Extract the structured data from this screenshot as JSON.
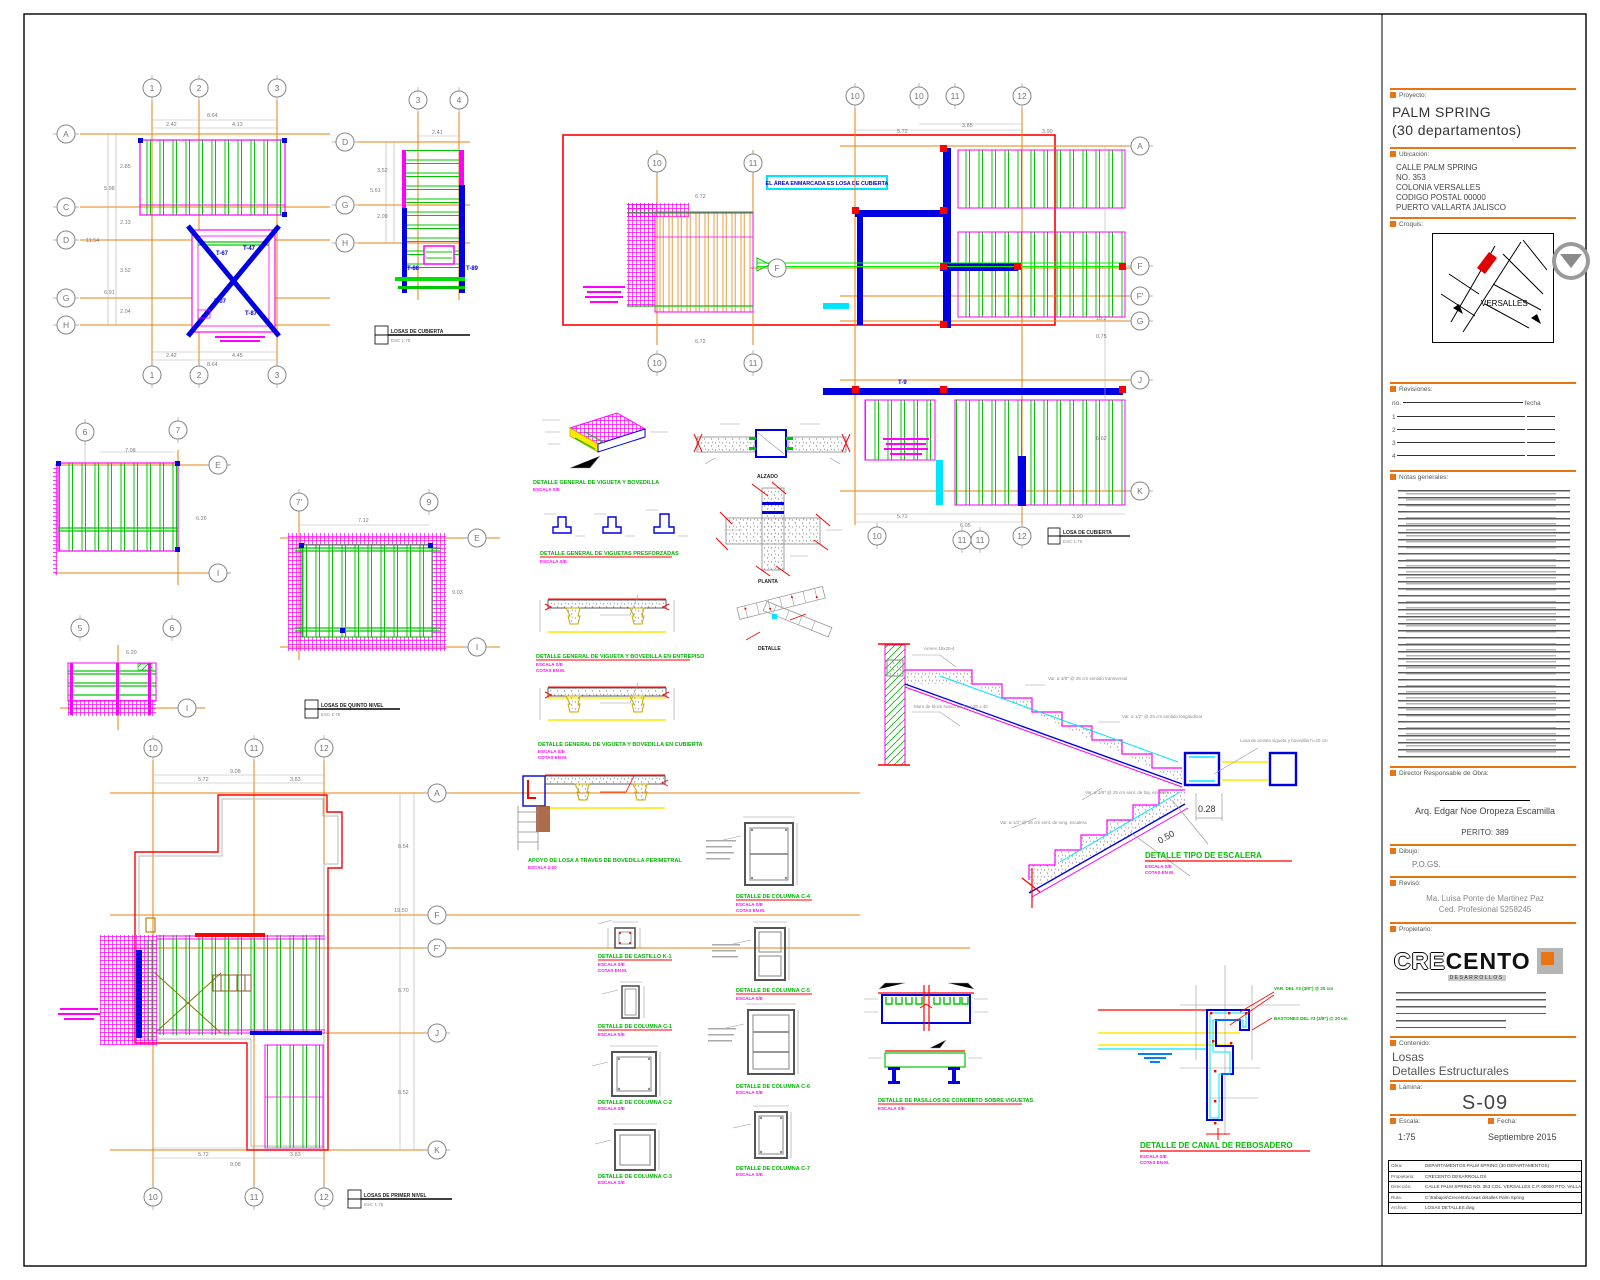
{
  "title_block": {
    "proyecto_label": "Proyecto:",
    "project_name_1": "PALM SPRING",
    "project_name_2": "(30 departamentos)",
    "ubicacion_label": "Ubicación:",
    "address": [
      "CALLE PALM SPRING",
      "NO. 353",
      "COLONIA VERSALLES",
      "CODIGO POSTAL 00000",
      "PUERTO VALLARTA JALISCO"
    ],
    "croquis_label": "Croquis:",
    "map_area_label": "VERSALLES",
    "revisiones_label": "Revisiones:",
    "rev_col_no": "no.",
    "rev_col_fecha": "fecha",
    "rev_rows": [
      "1",
      "2",
      "3",
      "4"
    ],
    "notas_label": "Notas generales:",
    "dro_label": "Director Responsable de Obra:",
    "dro_name": "Arq. Edgar Noe Oropeza Escamilla",
    "dro_perito": "PERITO: 389",
    "dibujo_label": "Dibujo:",
    "dibujo_value": "P.O.GS.",
    "reviso_label": "Revisó:",
    "reviso_line1": "Ma. Luisa Ponte de Martinez Paz",
    "reviso_line2": "Ced. Profesional 5258245",
    "propietario_label": "Propietario:",
    "logo_cre": "CRE",
    "logo_cento": "CENTO",
    "logo_sub": "DESARROLLOS",
    "contenido_label": "Contenido:",
    "contenido_1": "Losas",
    "contenido_2": "Detalles Estructurales",
    "lamina_label": "Lámina:",
    "lamina_value": "S-09",
    "escala_label": "Escala:",
    "escala_value": "1:75",
    "fecha_label": "Fecha:",
    "fecha_value": "Septiembre 2015",
    "footer_rows": [
      {
        "k": "Obra:",
        "v": "DEPARTAMENTOS PALM SPRING (30 DEPARTAMENTOS)"
      },
      {
        "k": "Propietario:",
        "v": "CRECENTO DESARROLLOS"
      },
      {
        "k": "Dirección:",
        "v": "CALLE PALM SPRING NO. 353 COL. VERSALLES C.P. 00000 PTO. VALLARTA JAL."
      },
      {
        "k": "Ruta:",
        "v": "C:\\trabajos\\Crecento\\Losas detalles Palm Spring"
      },
      {
        "k": "Archivo:",
        "v": "LOSAS DETALLES.dwg"
      }
    ]
  },
  "plans": {
    "p1": {
      "cols": [
        "1",
        "2",
        "3"
      ],
      "rows": [
        "A",
        "C",
        "D",
        "G",
        "H"
      ],
      "dim_top": "8.64",
      "dim_top_a": "2.42",
      "dim_top_b": "4.13",
      "dims_left": [
        "2.85",
        "5.98",
        "2.13",
        "3.52",
        "6.91",
        "2.04"
      ],
      "dim_left_total": "11.54",
      "dim_bot_a": "2.42",
      "dim_bot_b": "4.45",
      "dim_bot": "8.64",
      "t1": "T-47",
      "t2": "T-67",
      "t3": "T-07",
      "t4": "T-87"
    },
    "p2": {
      "cols": [
        "3",
        "4"
      ],
      "rows": [
        "D",
        "G",
        "H"
      ],
      "dim_top": "2.41",
      "dims_left": [
        "3.52",
        "5.61",
        "2.09"
      ],
      "t1": "T-88",
      "t2": "T-89"
    },
    "p3": {
      "cols_top": [
        "10",
        "10",
        "11",
        "12"
      ],
      "inner_top": [
        "10",
        "11"
      ],
      "inner_bot": [
        "10",
        "11"
      ],
      "f_label": "F",
      "rows_right": [
        "A",
        "F",
        "F'",
        "G",
        "J",
        "K"
      ],
      "cols_bot": [
        "10",
        "11",
        "11",
        "12"
      ],
      "dims_top": [
        "5.72",
        "3.85",
        "3.90"
      ],
      "dims_bot": [
        "5.72",
        "3.90",
        "6.05"
      ],
      "dims_right": [
        "10.2",
        "0.75",
        "6.62"
      ],
      "dim_sub": "6.72",
      "t1": "T-9",
      "note": "EL ÁREA ENMARCADA ES LOSA DE CUBIERTA"
    },
    "p4": {
      "cols": [
        "6",
        "7"
      ],
      "rows": [
        "E",
        "I"
      ],
      "dim_top": "7.08",
      "dim_right": "6.26"
    },
    "p5": {
      "cols": [
        "5",
        "6"
      ],
      "rows": [
        "I"
      ],
      "dim_top": "6.20"
    },
    "p6": {
      "cols": [
        "7'",
        "9"
      ],
      "rows": [
        "E",
        "I"
      ],
      "dim_top": "7.12",
      "dim_right": "9.03"
    },
    "p7": {
      "cols": [
        "10",
        "11",
        "12"
      ],
      "rows": [
        "A",
        "F",
        "F'",
        "J",
        "K"
      ],
      "dims_top": [
        "5.72",
        "3.83",
        "9.08"
      ],
      "dims_bot": [
        "5.72",
        "3.83",
        "9.08"
      ],
      "dims_right": [
        "8.54",
        "19.50",
        "6.70",
        "8.52"
      ]
    }
  },
  "legends": {
    "l1": {
      "t": "LOSAS DE CUBIERTA",
      "e": "ESC 1:75"
    },
    "l2": {
      "t": "LOSAS DE QUINTO NIVEL",
      "e": "ESC 1:75"
    },
    "l3": {
      "t": "LOSAS DE PRIMER NIVEL",
      "e": "ESC 1:75"
    },
    "l4": {
      "t": "LOSA DE CUBIERTA",
      "e": "ESC 1:75"
    }
  },
  "details": {
    "d1": {
      "t": "DETALLE GENERAL DE VIGUETA Y BOVEDILLA",
      "s": "ESCALA S/E"
    },
    "d2": {
      "t": "DETALLE GENERAL DE VIGUETAS PRESFORZADAS",
      "s": "ESCALA S/E"
    },
    "d3": {
      "t": "DETALLE GENERAL DE VIGUETA Y BOVEDILLA EN ENTREPISO",
      "s": "ESCALA S/E",
      "c": "COTAS EN M."
    },
    "d4": {
      "t": "DETALLE GENERAL DE VIGUETA Y BOVEDILLA EN CUBIERTA",
      "s": "ESCALA S/E",
      "c": "COTAS EN M."
    },
    "d5": {
      "t": "APOYO DE LOSA A TRAVES DE BOVEDILLA PERIMETRAL",
      "s": "ESCALA 1:10"
    },
    "d6": {
      "t": "DETALLE DE CASTILLO K-1",
      "s": "ESCALA S/E",
      "c": "COTAS EN M."
    },
    "d7": {
      "t": "DETALLE DE COLUMNA C-1",
      "s": "ESCALA S/E",
      "c": "COTAS EN M."
    },
    "d8": {
      "t": "DETALLE DE COLUMNA C-2",
      "s": "ESCALA S/E"
    },
    "d9": {
      "t": "DETALLE DE COLUMNA C-3",
      "s": "ESCALA S/E"
    },
    "d10": {
      "t": "DETALLE DE COLUMNA C-4",
      "s": "ESCALA S/E",
      "c": "COTAS EN M."
    },
    "d11": {
      "t": "DETALLE DE COLUMNA C-5",
      "s": "ESCALA S/E",
      "c": "COTAS EN M."
    },
    "d12": {
      "t": "DETALLE DE COLUMNA C-6",
      "s": "ESCALA S/E"
    },
    "d13": {
      "t": "DETALLE DE COLUMNA C-7",
      "s": "ESCALA S/E"
    },
    "alzado": "ALZADO",
    "planta": "PLANTA",
    "iso": "DETALLE",
    "d17": {
      "t": "DETALLE DE PASILLOS DE CONCRETO SOBRE VIGUETAS",
      "s": "ESCALA S/E"
    },
    "d18": {
      "t": "DETALLE TIPO DE ESCALERA",
      "s": "ESCALA S/E",
      "c": "COTAS EN M."
    },
    "d19": {
      "t": "DETALLE DE CANAL DE REBOSADERO",
      "s": "ESCALA S/E",
      "c": "COTAS EN M."
    }
  },
  "stair": {
    "armex": "Armex 15x20-4",
    "muro": "Muro de block hueco de 15 x 20 x 40",
    "a1": "Var. ø 3/8\" @ 25 cm sentido transversal",
    "a2": "Var. ø 1/2\" @ 25 cm sentido longitudinal",
    "a3": "Var. ø 3/8\" @ 25 cm sent. de baj. escalera",
    "a4": "Var. ø 1/2\" @ 25 cm sent. de long. escalera",
    "losa": "Losa de azotea vigueta y bovedilla h=20 cm",
    "d1": "0.28",
    "d2": "0.50"
  },
  "canal": {
    "a1": "VAR. DEL #3 (3/8\") @ 20 cm",
    "a2": "BASTONES DEL #3 (3/8\") @ 20 cm"
  },
  "colors": {
    "accent_orange": "#E87511",
    "grid_orange": "#E8820C",
    "joist_green": "#00C800",
    "slab_magenta": "#FF00FF",
    "beam_blue": "#0000E0",
    "mark_red": "#FF0000",
    "note_cyan": "#00E5FF"
  }
}
